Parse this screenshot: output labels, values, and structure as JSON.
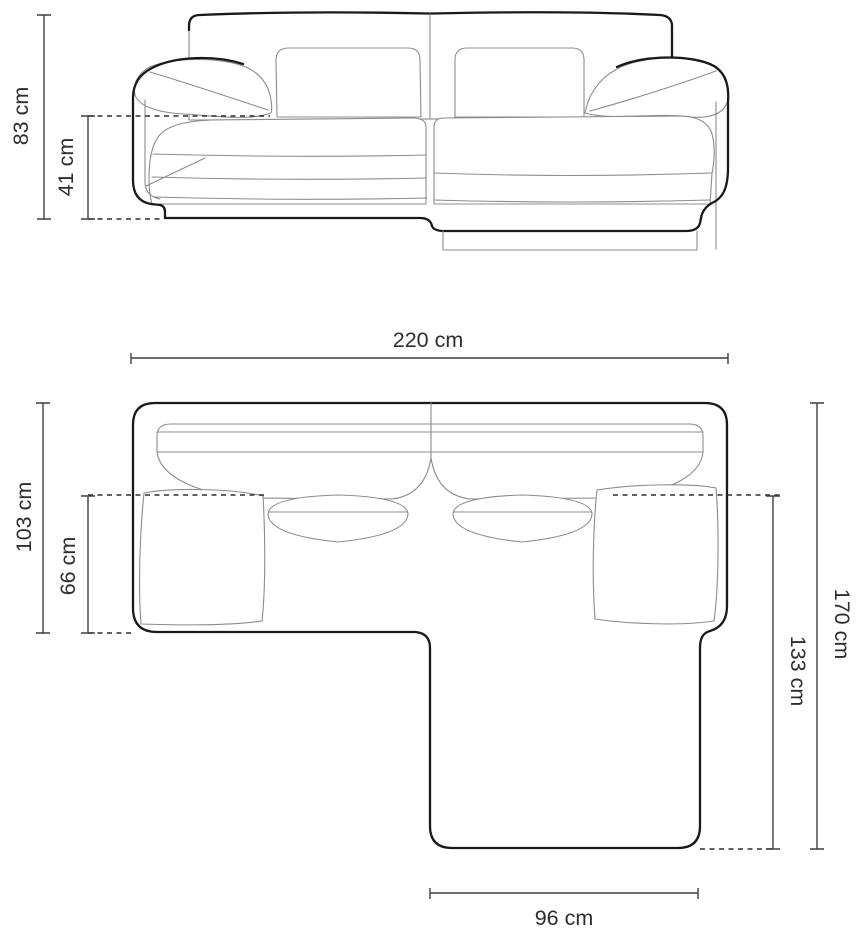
{
  "diagram": {
    "type": "sofa-dimension-drawing",
    "unit": "cm",
    "colors": {
      "background": "#ffffff",
      "outline": "#1a1a1a",
      "detail_line": "#8c8c8c",
      "dimension_line": "#3f3f3f",
      "text": "#2e2e2e"
    },
    "front_view": {
      "dimensions": {
        "total_height": {
          "label": "83 cm",
          "value": 83
        },
        "seat_height": {
          "label": "41 cm",
          "value": 41
        }
      }
    },
    "top_view": {
      "dimensions": {
        "total_width": {
          "label": "220 cm",
          "value": 220
        },
        "body_depth": {
          "label": "103 cm",
          "value": 103
        },
        "seat_depth": {
          "label": "66 cm",
          "value": 66
        },
        "total_depth": {
          "label": "170 cm",
          "value": 170
        },
        "chaise_depth": {
          "label": "133 cm",
          "value": 133
        },
        "chaise_width": {
          "label": "96 cm",
          "value": 96
        }
      }
    }
  }
}
